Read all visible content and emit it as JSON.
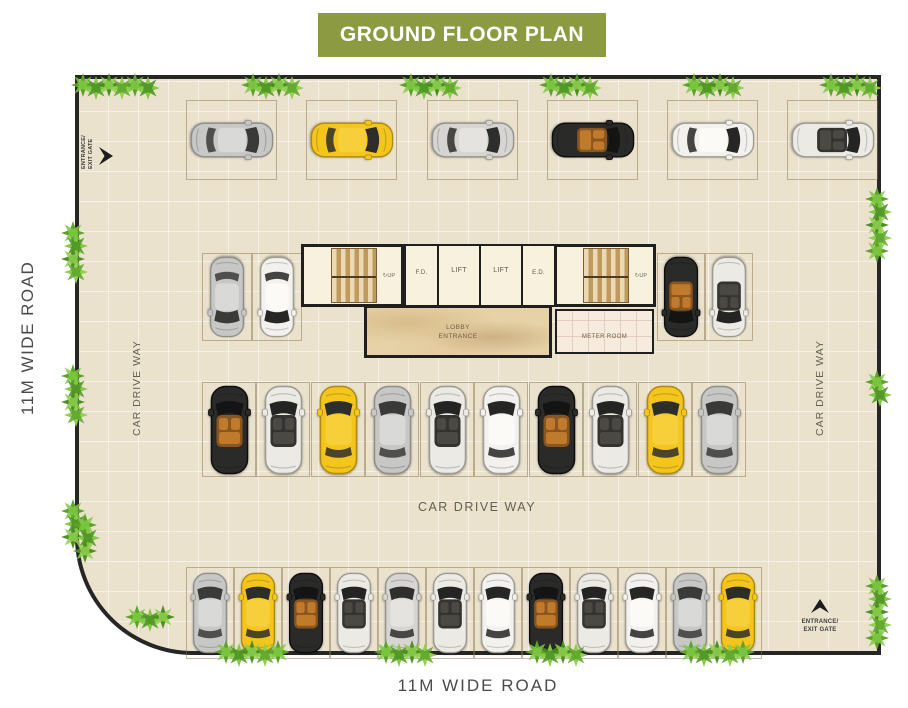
{
  "title": "GROUND FLOOR PLAN",
  "colors": {
    "banner_bg": "#8c9a41",
    "banner_text": "#ffffff",
    "floor": "#ebe2cd",
    "wall": "#262626",
    "road_text": "#4a4a4a",
    "label_text": "#64604e",
    "lobby_floor": "#e6d2a6",
    "meter_floor": "#f6ebdc",
    "stair_light": "#ead9b4",
    "stair_dark": "#bf9a5c",
    "plant_greens": [
      "#5da32b",
      "#7fc943",
      "#4c8f22",
      "#8fd04f"
    ]
  },
  "labels": {
    "road_left": "11M WIDE ROAD",
    "road_bottom": "11M WIDE ROAD",
    "driveway_left": "CAR DRIVE WAY",
    "driveway_right": "CAR DRIVE WAY",
    "driveway_center": "CAR DRIVE WAY",
    "gate_top_left": "ENTRANCE/ EXIT GATE",
    "gate_bottom_right": "ENTRANCE/ EXIT GATE"
  },
  "core": {
    "fd": "F.D.",
    "lift_1": "LIFT",
    "lift_2": "LIFT",
    "ed": "E.D.",
    "lobby": "LOBBY ENTRANCE",
    "meter": "METER ROOM",
    "up_left": "UP",
    "up_right": "UP"
  },
  "icons": {
    "up_arrow": "↻",
    "gate_arrow": "chevron",
    "plant": "eight-petal-bush"
  },
  "car_palette": {
    "suv_silver": {
      "body": "#c7c7c5",
      "glass": "#3a3a38",
      "top": "#d9d9d7",
      "stroke": "#8f8f8b"
    },
    "sedan_white": {
      "body": "#f2f1ed",
      "glass": "#262624",
      "top": "#fbfaf7",
      "stroke": "#a09d94"
    },
    "sedan_silver": {
      "body": "#d6d5d1",
      "glass": "#2e2e2c",
      "top": "#e4e3df",
      "stroke": "#96948c"
    },
    "hatch_yellow": {
      "body": "#f4c51d",
      "glass": "#2d2d2b",
      "top": "#f7cf3a",
      "stroke": "#b08a10"
    },
    "conv_black": {
      "body": "#2a2a28",
      "glass": "#141414",
      "top": "#8a551f",
      "seats": "#c07a2c",
      "stroke": "#0d0d0d"
    },
    "conv_white": {
      "body": "#eceae5",
      "glass": "#242422",
      "top": "#34332f",
      "seats": "#4a4944",
      "stroke": "#9c9a92"
    }
  },
  "parking_rows": [
    {
      "id": "top-row",
      "y": 21,
      "stall_w": 91,
      "stall_h": 80,
      "xs": [
        107,
        227,
        348,
        468,
        588,
        708
      ],
      "rot": 90,
      "car_w": 42,
      "car_h": 84,
      "cars": [
        "suv_silver",
        "hatch_yellow",
        "sedan_silver",
        "conv_black",
        "sedan_white",
        "conv_white"
      ]
    },
    {
      "id": "mid-left-pair",
      "y": 174,
      "stall_w": 50,
      "stall_h": 88,
      "xs": [
        123,
        173
      ],
      "rot": 180,
      "car_w": 40,
      "car_h": 82,
      "cars": [
        "suv_silver",
        "sedan_white"
      ]
    },
    {
      "id": "mid-right-pair",
      "y": 174,
      "stall_w": 48,
      "stall_h": 88,
      "xs": [
        578,
        626
      ],
      "rot": 180,
      "car_w": 40,
      "car_h": 82,
      "cars": [
        "conv_black",
        "conv_white"
      ]
    },
    {
      "id": "middle-row",
      "y": 303,
      "stall_w": 54,
      "stall_h": 95,
      "xs": [
        123,
        177,
        232,
        286,
        341,
        395,
        450,
        504,
        559,
        613
      ],
      "rot": 0,
      "car_w": 45,
      "car_h": 90,
      "cars": [
        "conv_black",
        "conv_white",
        "hatch_yellow",
        "suv_silver",
        "conv_white",
        "sedan_white",
        "conv_black",
        "conv_white",
        "hatch_yellow",
        "suv_silver"
      ]
    },
    {
      "id": "bottom-row",
      "y": 488,
      "stall_w": 48,
      "stall_h": 92,
      "xs": [
        107,
        155,
        203,
        251,
        299,
        347,
        395,
        443,
        491,
        539,
        587,
        635
      ],
      "rot": 0,
      "car_w": 40,
      "car_h": 84,
      "cars": [
        "suv_silver",
        "hatch_yellow",
        "conv_black",
        "conv_white",
        "sedan_silver",
        "conv_white",
        "sedan_white",
        "conv_black",
        "conv_white",
        "sedan_white",
        "suv_silver",
        "hatch_yellow"
      ]
    }
  ],
  "plants": [
    {
      "x": 115,
      "y": 86,
      "o": "h",
      "n": 6
    },
    {
      "x": 272,
      "y": 86,
      "o": "h",
      "n": 4
    },
    {
      "x": 430,
      "y": 86,
      "o": "h",
      "n": 4
    },
    {
      "x": 570,
      "y": 86,
      "o": "h",
      "n": 4
    },
    {
      "x": 713,
      "y": 86,
      "o": "h",
      "n": 4
    },
    {
      "x": 850,
      "y": 86,
      "o": "h",
      "n": 4
    },
    {
      "x": 74,
      "y": 252,
      "o": "v",
      "n": 4
    },
    {
      "x": 74,
      "y": 395,
      "o": "v",
      "n": 4
    },
    {
      "x": 74,
      "y": 524,
      "o": "v",
      "n": 3
    },
    {
      "x": 878,
      "y": 225,
      "o": "v",
      "n": 5
    },
    {
      "x": 878,
      "y": 388,
      "o": "v",
      "n": 2
    },
    {
      "x": 878,
      "y": 612,
      "o": "v",
      "n": 5
    },
    {
      "x": 252,
      "y": 653,
      "o": "h",
      "n": 5
    },
    {
      "x": 405,
      "y": 653,
      "o": "h",
      "n": 4
    },
    {
      "x": 556,
      "y": 653,
      "o": "h",
      "n": 4
    },
    {
      "x": 717,
      "y": 653,
      "o": "h",
      "n": 5
    },
    {
      "x": 86,
      "y": 538,
      "o": "v",
      "n": 3
    },
    {
      "x": 150,
      "y": 618,
      "o": "h",
      "n": 3
    }
  ]
}
